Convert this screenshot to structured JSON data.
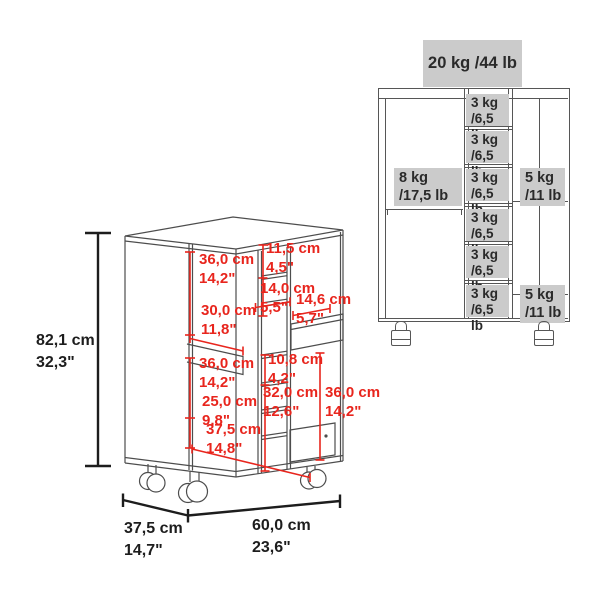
{
  "colors": {
    "dimension_red": "#e8251d",
    "drawing_gray": "#4d4d4d",
    "dimension_black": "#1d1d1d",
    "capacity_label_bg": "#cbcbcb"
  },
  "left_diagram": {
    "overall_dimensions": {
      "height": {
        "cm": "82,1 cm",
        "inch": "32,3\""
      },
      "depth": {
        "cm": "37,5 cm",
        "inch": "14,7\""
      },
      "width": {
        "cm": "60,0 cm",
        "inch": "23,6\""
      }
    },
    "interior_dimensions": [
      {
        "id": "left-upper-height",
        "cm": "36,0 cm",
        "inch": "14,2\""
      },
      {
        "id": "shelf-depth",
        "cm": "30,0 cm",
        "inch": "11,8\""
      },
      {
        "id": "top-cubby-height",
        "cm": "11,5 cm",
        "inch": "4,5\""
      },
      {
        "id": "second-cubby-height",
        "cm": "14,0 cm",
        "inch": "5,5\""
      },
      {
        "id": "drawer-width",
        "cm": "14,6 cm",
        "inch": "5,7\""
      },
      {
        "id": "left-lower-height",
        "cm": "36,0 cm",
        "inch": "14,2\""
      },
      {
        "id": "lower-shelf-height",
        "cm": "25,0 cm",
        "inch": "9,8\""
      },
      {
        "id": "interior-depth",
        "cm": "37,5 cm",
        "inch": "14,8\""
      },
      {
        "id": "small-cubby-height",
        "cm": "10,8 cm",
        "inch": "4,2\""
      },
      {
        "id": "lower-column-height",
        "cm": "32,0 cm",
        "inch": "12,6\""
      },
      {
        "id": "right-lower-height",
        "cm": "36,0 cm",
        "inch": "14,2\""
      }
    ]
  },
  "right_diagram": {
    "total_capacity": "20 kg /44 lb",
    "left_compartment": {
      "line1": "8 kg",
      "line2": "/17,5 lb"
    },
    "middle_cells": [
      {
        "line1": "3 kg",
        "line2": "/6,5 lb"
      },
      {
        "line1": "3 kg",
        "line2": "/6,5 lb"
      },
      {
        "line1": "3 kg",
        "line2": "/6,5 lb"
      },
      {
        "line1": "3 kg",
        "line2": "/6,5 lb"
      },
      {
        "line1": "3 kg",
        "line2": "/6,5 lb"
      },
      {
        "line1": "3 kg",
        "line2": "/6,5 lb"
      }
    ],
    "right_cells": [
      {
        "line1": "5 kg",
        "line2": "/11 lb"
      },
      {
        "line1": "5 kg",
        "line2": "/11 lb"
      }
    ]
  }
}
